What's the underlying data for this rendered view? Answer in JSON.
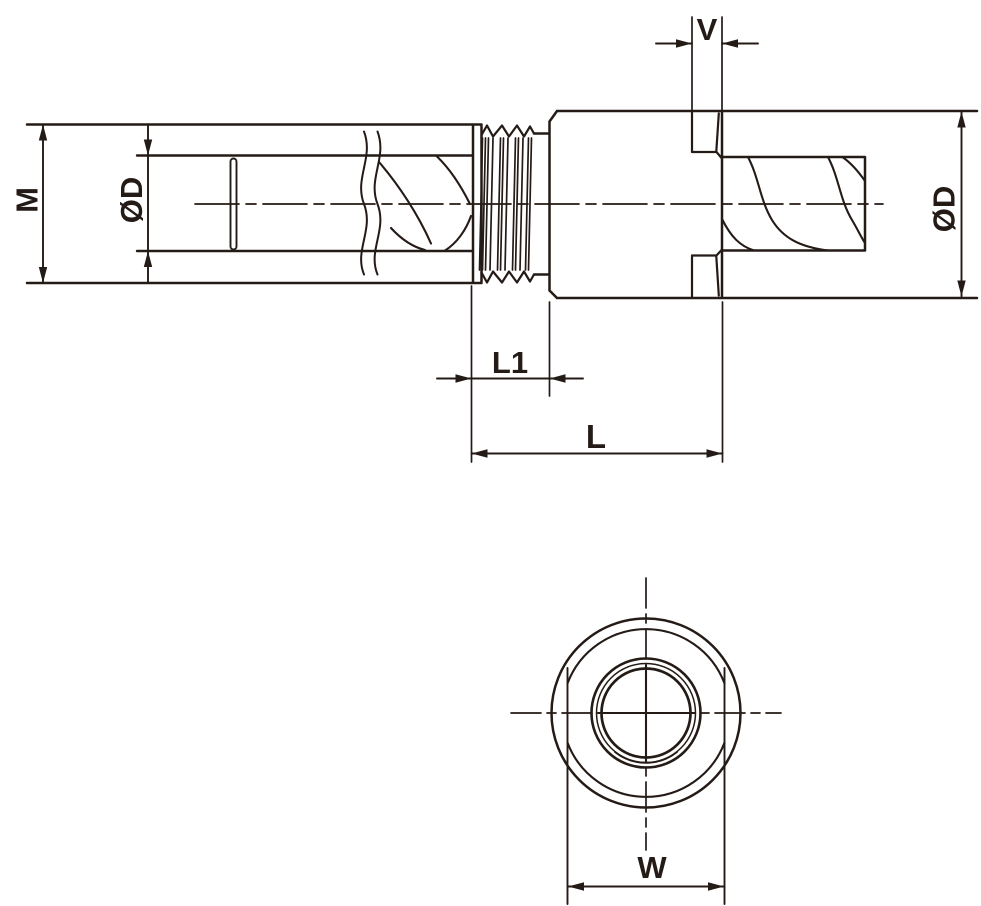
{
  "drawing": {
    "colors": {
      "line": "#241a16",
      "background": "#ffffff"
    },
    "labels": {
      "m": "M",
      "d_left": "ØD",
      "v": "V",
      "d_right": "ØD",
      "l1": "L1",
      "l": "L",
      "w": "W"
    }
  }
}
